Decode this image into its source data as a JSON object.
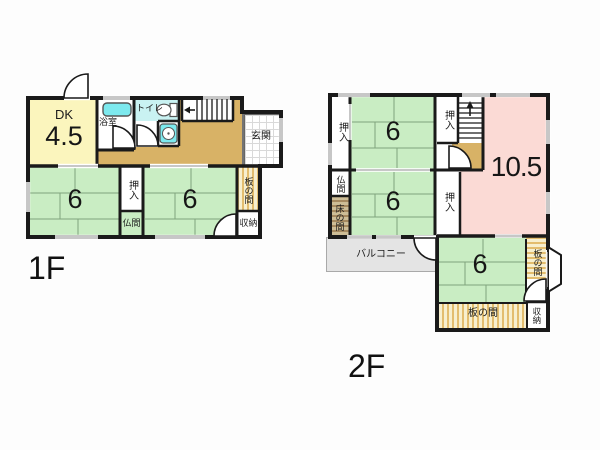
{
  "floors": [
    {
      "id": "1F",
      "label": "1F",
      "rooms": {
        "dk": {
          "label": "DK",
          "size": "4.5"
        },
        "bathroom": "浴室",
        "toilet": "トイレ",
        "entrance": "玄関",
        "tatami_left": "6",
        "closet": "押入",
        "butsuma": "仏間",
        "tatami_right": "6",
        "itanoma": "板の間",
        "storage": "収納"
      }
    },
    {
      "id": "2F",
      "label": "2F",
      "rooms": {
        "closet_left": "押入",
        "tatami_top": "6",
        "closet_top": "押入",
        "main_room": "10.5",
        "butsuma": "仏間",
        "tokonoma": "床の間",
        "tatami_mid": "6",
        "closet_mid": "押入",
        "balcony": "バルコニー",
        "tatami_bottom": "6",
        "itanoma_right": "板の間",
        "itanoma_bottom": "板の間",
        "storage": "収納"
      }
    }
  ],
  "colors": {
    "wall": "#1a1a1a",
    "tatami_green": "#c9edc3",
    "dk_yellow": "#fbf5bd",
    "large_room_pink": "#fbdad5",
    "hallway_tan": "#d8b266",
    "bath_cyan": "#7de9ee",
    "toilet_cyan": "#c9f2f2",
    "balcony_gray": "#e4e4e4",
    "wood_stripe": "#e3bd6e",
    "tokonoma_brown": "#a5895f"
  }
}
